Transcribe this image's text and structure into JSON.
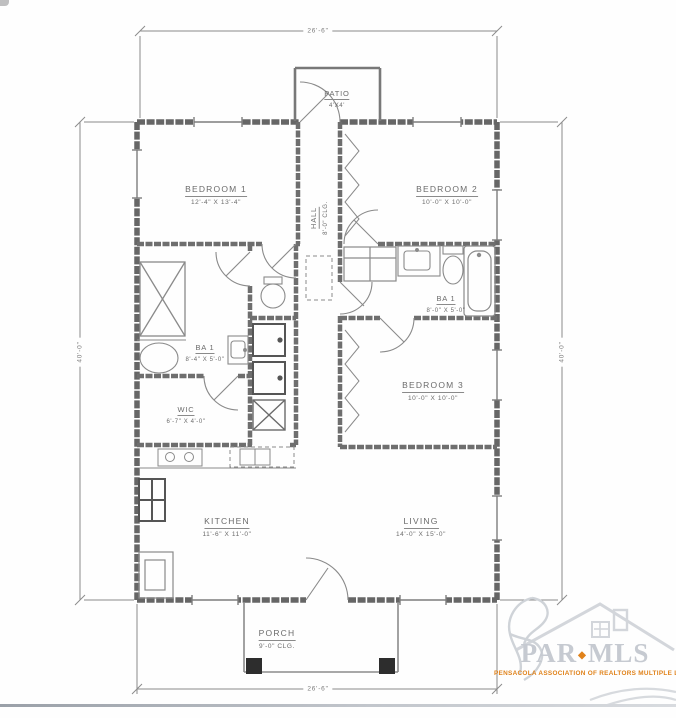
{
  "plan_title": "single-story residential floor plan",
  "dimensions": {
    "top": "26'-6\"",
    "bottom": "26'-6\"",
    "left": "40'-0\"",
    "right": "40'-0\""
  },
  "rooms": [
    {
      "id": "bedroom-1",
      "name": "BEDROOM 1",
      "dims": "12'-4\" X 13'-4\""
    },
    {
      "id": "bedroom-2",
      "name": "BEDROOM 2",
      "dims": "10'-0\" X 10'-0\""
    },
    {
      "id": "bedroom-3",
      "name": "BEDROOM 3",
      "dims": "10'-0\" X 10'-0\""
    },
    {
      "id": "hall",
      "name": "HALL",
      "dims": "8'-0\" CLG."
    },
    {
      "id": "bath-1-left",
      "name": "BA 1",
      "dims": "8'-4\" X 5'-0\""
    },
    {
      "id": "bath-1-right",
      "name": "BA 1",
      "dims": "8'-0\" X 5'-0\""
    },
    {
      "id": "wic",
      "name": "WIC",
      "dims": "6'-7\" X 4'-0\""
    },
    {
      "id": "kitchen",
      "name": "KITCHEN",
      "dims": "11'-6\" X 11'-0\""
    },
    {
      "id": "living",
      "name": "LIVING",
      "dims": "14'-0\" X 15'-0\""
    },
    {
      "id": "porch",
      "name": "PORCH",
      "dims": "9'-0\" CLG."
    },
    {
      "id": "patio",
      "name": "PATIO",
      "dims": "4'X4'"
    }
  ],
  "watermark": {
    "word1": "PAR",
    "word2": "MLS",
    "separator": "◆",
    "tagline": "PENSACOLA ASSOCIATION OF REALTORS MULTIPLE LISTING"
  },
  "colors": {
    "wall_gray": "#666666",
    "thin_line_gray": "#8b8b8b",
    "label_gray": "#6b6b6b",
    "watermark_gray": "#c6cad1",
    "watermark_orange": "#e0821a"
  }
}
